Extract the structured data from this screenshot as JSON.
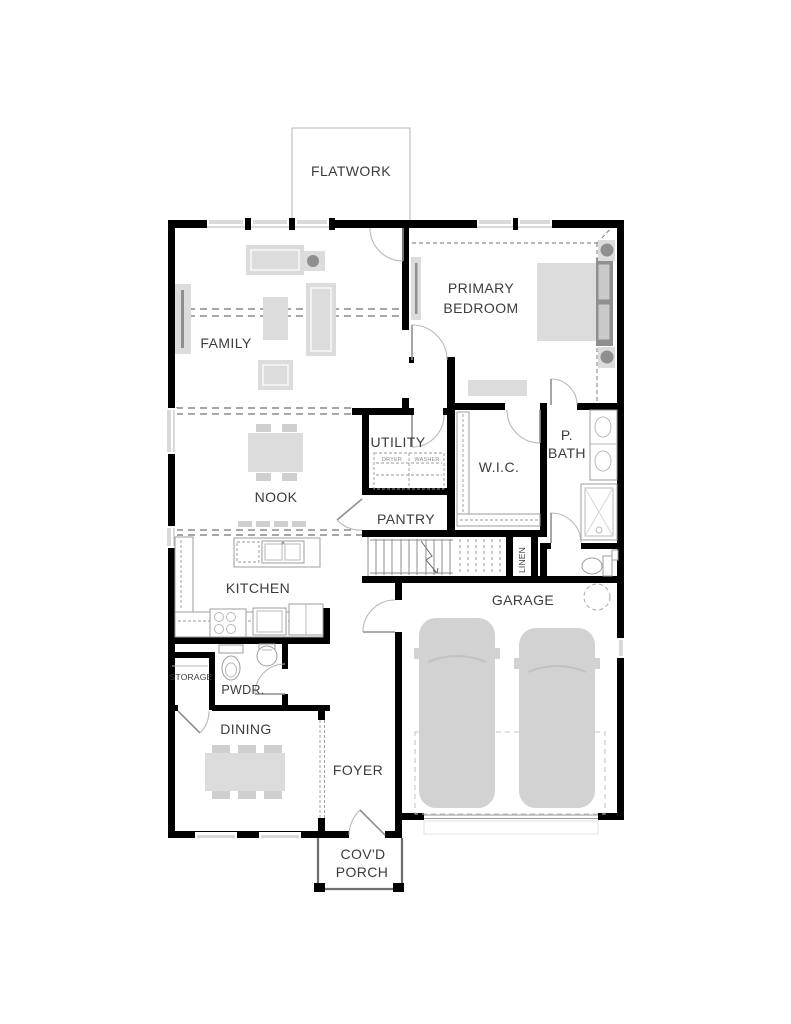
{
  "colors": {
    "wall": "#000000",
    "furniture_fill": "#dcdcdc",
    "furniture_dark": "#8f8f8f",
    "fixture_line": "#9e9e9e",
    "window_fill": "#d9d9d9",
    "label_text": "#3c3c3c",
    "background": "#ffffff"
  },
  "rooms": {
    "flatwork": {
      "label": "FLATWORK"
    },
    "family": {
      "label": "FAMILY"
    },
    "primary_bedroom": {
      "label_line1": "PRIMARY",
      "label_line2": "BEDROOM"
    },
    "utility": {
      "label": "UTILITY",
      "dryer_label": "DRYER",
      "washer_label": "WASHER"
    },
    "walk_in_closet": {
      "label": "W.I.C."
    },
    "primary_bath": {
      "label_line1": "P.",
      "label_line2": "BATH"
    },
    "nook": {
      "label": "NOOK"
    },
    "pantry": {
      "label": "PANTRY"
    },
    "linen": {
      "label": "LINEN"
    },
    "kitchen": {
      "label": "KITCHEN"
    },
    "garage": {
      "label": "GARAGE"
    },
    "storage": {
      "label": "STORAGE"
    },
    "powder": {
      "label": "PWDR."
    },
    "dining": {
      "label": "DINING"
    },
    "foyer": {
      "label": "FOYER"
    },
    "covered_porch": {
      "label_line1": "COV'D",
      "label_line2": "PORCH"
    }
  }
}
